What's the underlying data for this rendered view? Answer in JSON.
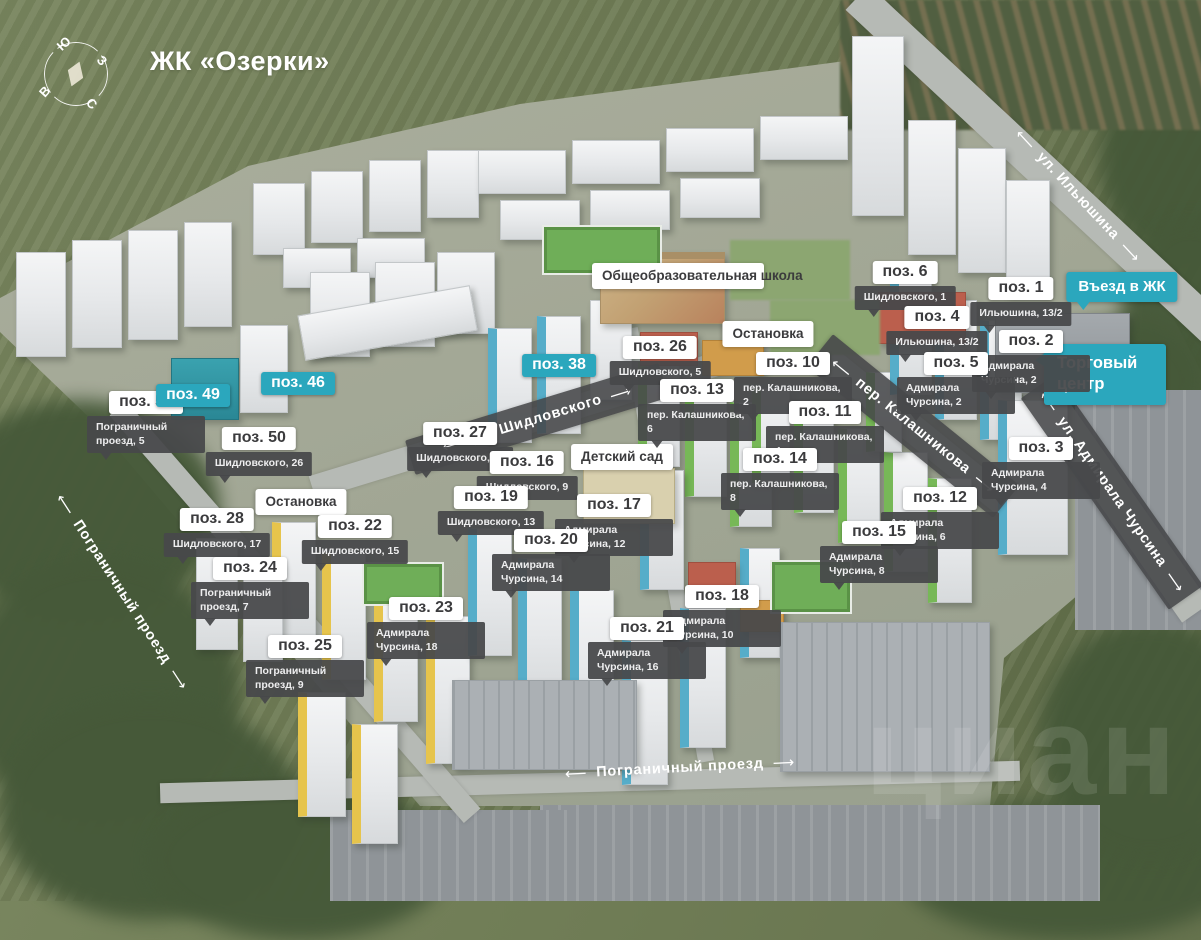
{
  "title": "ЖК «Озерки»",
  "watermark": "циан",
  "compass": {
    "south": "Ю",
    "west": "З",
    "east": "В",
    "north": "С"
  },
  "colors": {
    "accent_teal": "#2ba7bd",
    "label_dark": "#48494b",
    "label_white": "#ffffff",
    "label_text": "#3b3b3d"
  },
  "map": {
    "markers": [
      {
        "id": "53",
        "label": "поз. 53",
        "address": "Пограничный проезд, 5",
        "x": 146,
        "y": 391
      },
      {
        "id": "49",
        "label": "поз. 49",
        "highlighted": true,
        "x": 193,
        "y": 384
      },
      {
        "id": "46",
        "label": "поз. 46",
        "highlighted": true,
        "x": 298,
        "y": 372
      },
      {
        "id": "50",
        "label": "поз. 50",
        "address": "Шидловского, 26",
        "x": 259,
        "y": 427
      },
      {
        "id": "27",
        "label": "поз. 27",
        "address": "Шидловского, 11",
        "x": 460,
        "y": 422
      },
      {
        "id": "38",
        "label": "поз. 38",
        "highlighted": true,
        "x": 559,
        "y": 354
      },
      {
        "id": "26",
        "label": "поз. 26",
        "address": "Шидловского, 5",
        "x": 660,
        "y": 336
      },
      {
        "id": "13",
        "label": "поз. 13",
        "address": "пер. Калашникова, 6",
        "x": 697,
        "y": 379
      },
      {
        "id": "10",
        "label": "поз. 10",
        "address": "пер. Калашникова, 2",
        "x": 793,
        "y": 352
      },
      {
        "id": "11",
        "label": "поз. 11",
        "address": "пер. Калашникова, 4",
        "x": 825,
        "y": 401
      },
      {
        "id": "14",
        "label": "поз. 14",
        "address": "пер. Калашникова, 8",
        "x": 780,
        "y": 448
      },
      {
        "id": "6",
        "label": "поз. 6",
        "address": "Шидловского, 1",
        "x": 905,
        "y": 261
      },
      {
        "id": "1",
        "label": "поз. 1",
        "address": "Ильюшина, 13/2",
        "x": 1021,
        "y": 277
      },
      {
        "id": "4",
        "label": "поз. 4",
        "address": "Ильюшина, 13/2",
        "x": 937,
        "y": 306
      },
      {
        "id": "2",
        "label": "поз. 2",
        "address": "Адмирала Чурсина, 2",
        "x": 1031,
        "y": 330
      },
      {
        "id": "5",
        "label": "поз. 5",
        "address": "Адмирала Чурсина, 2",
        "x": 956,
        "y": 352
      },
      {
        "id": "3",
        "label": "поз. 3",
        "address": "Адмирала Чурсина, 4",
        "x": 1041,
        "y": 437
      },
      {
        "id": "12",
        "label": "поз. 12",
        "address": "Адмирала Чурсина, 6",
        "x": 940,
        "y": 487
      },
      {
        "id": "15",
        "label": "поз. 15",
        "address": "Адмирала Чурсина, 8",
        "x": 879,
        "y": 521
      },
      {
        "id": "16",
        "label": "поз. 16",
        "address": "Шидловского, 9",
        "x": 527,
        "y": 451
      },
      {
        "id": "19",
        "label": "поз. 19",
        "address": "Шидловского, 13",
        "x": 491,
        "y": 486
      },
      {
        "id": "17",
        "label": "поз. 17",
        "address": "Адмирала Чурсина, 12",
        "x": 614,
        "y": 494
      },
      {
        "id": "20",
        "label": "поз. 20",
        "address": "Адмирала Чурсина, 14",
        "x": 551,
        "y": 529
      },
      {
        "id": "18",
        "label": "поз. 18",
        "address": "Адмирала Чурсина, 10",
        "x": 722,
        "y": 585
      },
      {
        "id": "21",
        "label": "поз. 21",
        "address": "Адмирала Чурсина, 16",
        "x": 647,
        "y": 617
      },
      {
        "id": "28",
        "label": "поз. 28",
        "address": "Шидловского, 17",
        "x": 217,
        "y": 508
      },
      {
        "id": "22",
        "label": "поз. 22",
        "address": "Шидловского, 15",
        "x": 355,
        "y": 515
      },
      {
        "id": "24",
        "label": "поз. 24",
        "address": "Пограничный проезд, 7",
        "x": 250,
        "y": 557
      },
      {
        "id": "23",
        "label": "поз. 23",
        "address": "Адмирала Чурсина, 18",
        "x": 426,
        "y": 597
      },
      {
        "id": "25",
        "label": "поз. 25",
        "address": "Пограничный проезд, 9",
        "x": 305,
        "y": 635
      }
    ],
    "landmarks": [
      {
        "id": "school",
        "text": "Общеобразовательная школа",
        "style": "white wrap",
        "x": 678,
        "y": 263,
        "w": 152
      },
      {
        "id": "bus-stop-east",
        "text": "Остановка",
        "style": "white",
        "x": 768,
        "y": 321
      },
      {
        "id": "bus-stop-west",
        "text": "Остановка",
        "style": "white",
        "x": 301,
        "y": 489
      },
      {
        "id": "kindergarten",
        "text": "Детский сад",
        "style": "white",
        "x": 622,
        "y": 444
      },
      {
        "id": "entrance",
        "text": "Въезд в ЖК",
        "style": "teal ptr-b",
        "x": 1122,
        "y": 272
      },
      {
        "id": "mall",
        "text": "Торговый центр",
        "style": "teal-big ptr-l",
        "x": 1105,
        "y": 344
      }
    ],
    "streets": [
      {
        "id": "ilyushina",
        "name": "ул. Ильюшина",
        "cx": 1078,
        "cy": 196,
        "angle": 47,
        "banded": false
      },
      {
        "id": "shidlovskogo",
        "name": "ул. Шидловского",
        "cx": 537,
        "cy": 419,
        "angle": -17,
        "banded": true,
        "bw": 265,
        "bh": 36
      },
      {
        "id": "kalashnikova",
        "name": "пер. Калашникова",
        "cx": 913,
        "cy": 426,
        "angle": 39,
        "banded": true,
        "bw": 240,
        "bh": 42
      },
      {
        "id": "admirala-chursina",
        "name": "ул. Адмирала Чурсина",
        "cx": 1112,
        "cy": 492,
        "angle": 55,
        "banded": true,
        "bw": 258,
        "bh": 42
      },
      {
        "id": "pogranichny-west",
        "name": "Пограничный проезд",
        "cx": 122,
        "cy": 592,
        "angle": 57,
        "banded": false
      },
      {
        "id": "pogranichny-south",
        "name": "Пограничный проезд",
        "cx": 680,
        "cy": 768,
        "angle": -3,
        "banded": false
      }
    ],
    "roads": [
      {
        "cx": 1040,
        "cy": 168,
        "len": 500,
        "wd": 34,
        "angle": 43
      },
      {
        "cx": 590,
        "cy": 782,
        "len": 860,
        "wd": 20,
        "angle": -1.5
      },
      {
        "cx": 295,
        "cy": 612,
        "len": 540,
        "wd": 22,
        "angle": 49
      },
      {
        "cx": 537,
        "cy": 419,
        "len": 470,
        "wd": 24,
        "angle": -17
      },
      {
        "cx": 912,
        "cy": 428,
        "len": 310,
        "wd": 28,
        "angle": 39
      },
      {
        "cx": 1110,
        "cy": 490,
        "len": 300,
        "wd": 34,
        "angle": 55
      },
      {
        "cx": 668,
        "cy": 545,
        "len": 440,
        "wd": 16,
        "angle": 80
      }
    ],
    "scenery": [
      {
        "x": -60,
        "y": 400,
        "w": 280,
        "h": 220,
        "c": "trees"
      },
      {
        "x": -40,
        "y": 560,
        "w": 280,
        "h": 260,
        "c": "trees"
      },
      {
        "x": 0,
        "y": 700,
        "w": 300,
        "h": 220,
        "c": "trees"
      },
      {
        "x": 150,
        "y": 780,
        "w": 300,
        "h": 160,
        "c": "trees"
      },
      {
        "x": 900,
        "y": 800,
        "w": 340,
        "h": 140,
        "c": "trees"
      },
      {
        "x": 1040,
        "y": 620,
        "w": 220,
        "h": 240,
        "c": "trees"
      },
      {
        "x": 1100,
        "y": 60,
        "w": 160,
        "h": 200,
        "c": "trees"
      },
      {
        "x": 1120,
        "y": 220,
        "w": 140,
        "h": 200,
        "c": "trees"
      },
      {
        "x": 1040,
        "y": 320,
        "w": 160,
        "h": 120,
        "c": "trees"
      },
      {
        "x": 840,
        "y": 0,
        "w": 380,
        "h": 130,
        "c": "village"
      },
      {
        "x": 1075,
        "y": 390,
        "w": 126,
        "h": 240,
        "c": "industrial"
      },
      {
        "x": 540,
        "y": 805,
        "w": 560,
        "h": 96,
        "c": "industrial"
      },
      {
        "x": 330,
        "y": 810,
        "w": 240,
        "h": 91,
        "c": "industrial"
      }
    ],
    "buildings": [
      {
        "x": 253,
        "y": 183,
        "w": 52,
        "h": 72,
        "c": "w"
      },
      {
        "x": 311,
        "y": 171,
        "w": 52,
        "h": 72,
        "c": "w"
      },
      {
        "x": 369,
        "y": 160,
        "w": 52,
        "h": 72,
        "c": "w"
      },
      {
        "x": 427,
        "y": 150,
        "w": 52,
        "h": 68,
        "c": "w"
      },
      {
        "x": 283,
        "y": 248,
        "w": 68,
        "h": 40,
        "c": "w"
      },
      {
        "x": 357,
        "y": 238,
        "w": 68,
        "h": 40,
        "c": "w"
      },
      {
        "x": 478,
        "y": 150,
        "w": 88,
        "h": 44,
        "c": "w"
      },
      {
        "x": 572,
        "y": 140,
        "w": 88,
        "h": 44,
        "c": "w"
      },
      {
        "x": 666,
        "y": 128,
        "w": 88,
        "h": 44,
        "c": "w"
      },
      {
        "x": 760,
        "y": 116,
        "w": 88,
        "h": 44,
        "c": "w"
      },
      {
        "x": 500,
        "y": 200,
        "w": 80,
        "h": 40,
        "c": "w"
      },
      {
        "x": 590,
        "y": 190,
        "w": 80,
        "h": 40,
        "c": "w"
      },
      {
        "x": 680,
        "y": 178,
        "w": 80,
        "h": 40,
        "c": "w"
      },
      {
        "x": 852,
        "y": 36,
        "w": 52,
        "h": 180,
        "c": "w"
      },
      {
        "x": 908,
        "y": 120,
        "w": 48,
        "h": 135,
        "c": "w"
      },
      {
        "x": 958,
        "y": 148,
        "w": 48,
        "h": 125,
        "c": "w"
      },
      {
        "x": 1006,
        "y": 180,
        "w": 44,
        "h": 115,
        "c": "w"
      },
      {
        "x": 16,
        "y": 252,
        "w": 50,
        "h": 105,
        "c": "w"
      },
      {
        "x": 72,
        "y": 240,
        "w": 50,
        "h": 108,
        "c": "w"
      },
      {
        "x": 128,
        "y": 230,
        "w": 50,
        "h": 110,
        "c": "w"
      },
      {
        "x": 184,
        "y": 222,
        "w": 48,
        "h": 105,
        "c": "w"
      },
      {
        "x": 310,
        "y": 272,
        "w": 60,
        "h": 85,
        "c": "w"
      },
      {
        "x": 375,
        "y": 262,
        "w": 60,
        "h": 85,
        "c": "w"
      },
      {
        "x": 437,
        "y": 252,
        "w": 58,
        "h": 82,
        "c": "w"
      },
      {
        "x": 300,
        "y": 300,
        "w": 175,
        "h": 46,
        "c": "w",
        "r": -10
      },
      {
        "x": 171,
        "y": 358,
        "w": 68,
        "h": 62,
        "c": "t"
      },
      {
        "x": 240,
        "y": 325,
        "w": 48,
        "h": 88,
        "c": "w"
      },
      {
        "x": 488,
        "y": 328,
        "w": 44,
        "h": 115,
        "c": "b"
      },
      {
        "x": 537,
        "y": 316,
        "w": 44,
        "h": 118,
        "c": "b"
      },
      {
        "x": 590,
        "y": 300,
        "w": 42,
        "h": 100,
        "c": "w"
      },
      {
        "x": 600,
        "y": 252,
        "w": 125,
        "h": 72,
        "c": "s"
      },
      {
        "x": 542,
        "y": 225,
        "w": 120,
        "h": 50,
        "c": "f"
      },
      {
        "x": 638,
        "y": 362,
        "w": 42,
        "h": 105,
        "c": "g"
      },
      {
        "x": 685,
        "y": 382,
        "w": 42,
        "h": 115,
        "c": "g"
      },
      {
        "x": 730,
        "y": 402,
        "w": 42,
        "h": 125,
        "c": "g"
      },
      {
        "x": 752,
        "y": 388,
        "w": 38,
        "h": 95,
        "c": "g"
      },
      {
        "x": 794,
        "y": 408,
        "w": 40,
        "h": 105,
        "c": "g"
      },
      {
        "x": 838,
        "y": 428,
        "w": 42,
        "h": 115,
        "c": "g"
      },
      {
        "x": 884,
        "y": 452,
        "w": 44,
        "h": 120,
        "c": "g"
      },
      {
        "x": 928,
        "y": 478,
        "w": 44,
        "h": 125,
        "c": "g"
      },
      {
        "x": 866,
        "y": 372,
        "w": 36,
        "h": 80,
        "c": "g"
      },
      {
        "x": 890,
        "y": 280,
        "w": 42,
        "h": 115,
        "c": "b"
      },
      {
        "x": 935,
        "y": 300,
        "w": 42,
        "h": 120,
        "c": "b"
      },
      {
        "x": 980,
        "y": 320,
        "w": 42,
        "h": 120,
        "c": "b"
      },
      {
        "x": 998,
        "y": 400,
        "w": 70,
        "h": 155,
        "c": "b"
      },
      {
        "x": 995,
        "y": 313,
        "w": 135,
        "h": 80,
        "c": "m"
      },
      {
        "x": 272,
        "y": 522,
        "w": 44,
        "h": 118,
        "c": "y"
      },
      {
        "x": 322,
        "y": 552,
        "w": 44,
        "h": 128,
        "c": "y"
      },
      {
        "x": 374,
        "y": 584,
        "w": 44,
        "h": 138,
        "c": "y"
      },
      {
        "x": 426,
        "y": 616,
        "w": 44,
        "h": 148,
        "c": "y"
      },
      {
        "x": 298,
        "y": 692,
        "w": 48,
        "h": 125,
        "c": "y"
      },
      {
        "x": 352,
        "y": 724,
        "w": 46,
        "h": 120,
        "c": "y"
      },
      {
        "x": 196,
        "y": 538,
        "w": 42,
        "h": 112,
        "c": "w"
      },
      {
        "x": 243,
        "y": 562,
        "w": 40,
        "h": 100,
        "c": "w"
      },
      {
        "x": 468,
        "y": 528,
        "w": 44,
        "h": 128,
        "c": "b"
      },
      {
        "x": 518,
        "y": 558,
        "w": 44,
        "h": 138,
        "c": "b"
      },
      {
        "x": 570,
        "y": 590,
        "w": 44,
        "h": 148,
        "c": "b"
      },
      {
        "x": 622,
        "y": 640,
        "w": 46,
        "h": 145,
        "c": "b"
      },
      {
        "x": 680,
        "y": 608,
        "w": 46,
        "h": 140,
        "c": "b"
      },
      {
        "x": 640,
        "y": 470,
        "w": 44,
        "h": 120,
        "c": "b"
      },
      {
        "x": 740,
        "y": 548,
        "w": 40,
        "h": 110,
        "c": "b"
      },
      {
        "x": 583,
        "y": 468,
        "w": 92,
        "h": 56,
        "c": "k"
      },
      {
        "x": 878,
        "y": 292,
        "w": 88,
        "h": 52,
        "c": "r"
      },
      {
        "x": 640,
        "y": 332,
        "w": 58,
        "h": 34,
        "c": "r"
      },
      {
        "x": 702,
        "y": 340,
        "w": 62,
        "h": 36,
        "c": "o"
      },
      {
        "x": 688,
        "y": 562,
        "w": 48,
        "h": 38,
        "c": "r"
      },
      {
        "x": 740,
        "y": 600,
        "w": 44,
        "h": 32,
        "c": "o"
      },
      {
        "x": 770,
        "y": 560,
        "w": 82,
        "h": 54,
        "c": "f"
      },
      {
        "x": 362,
        "y": 562,
        "w": 82,
        "h": 44,
        "c": "f"
      },
      {
        "x": 452,
        "y": 680,
        "w": 185,
        "h": 90,
        "c": "p"
      },
      {
        "x": 780,
        "y": 622,
        "w": 210,
        "h": 150,
        "c": "p"
      },
      {
        "x": 730,
        "y": 240,
        "w": 120,
        "h": 60,
        "c": "lawn"
      },
      {
        "x": 770,
        "y": 300,
        "w": 110,
        "h": 55,
        "c": "lawn"
      }
    ]
  }
}
